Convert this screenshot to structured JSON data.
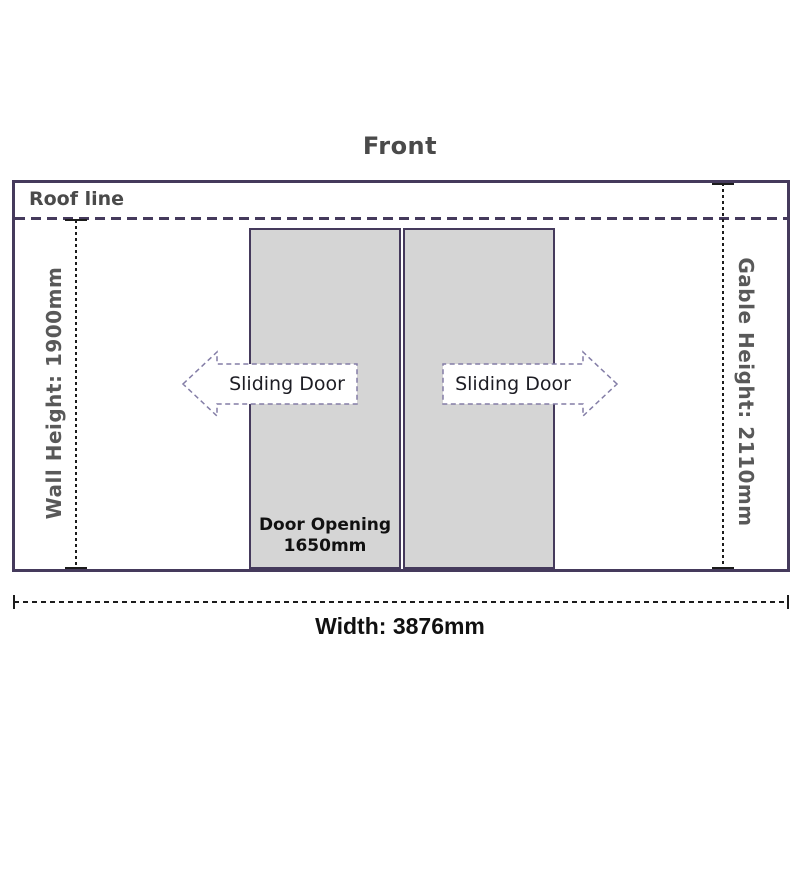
{
  "title": "Front",
  "labels": {
    "roof_line": "Roof line",
    "wall_height": "Wall Height: 1900mm",
    "gable_height": "Gable Height: 2110mm",
    "width": "Width: 3876mm"
  },
  "doors": {
    "left_arrow_label": "Sliding Door",
    "right_arrow_label": "Sliding Door",
    "opening_line1": "Door Opening",
    "opening_line2": "1650mm"
  },
  "colors": {
    "outline_purple": "#453a5c",
    "door_fill": "#d5d5d5",
    "heading_gray": "#4a4a4a",
    "side_label_gray": "#595959",
    "arrow_outline": "#837da6",
    "dimension_black": "#1c1c1c"
  }
}
